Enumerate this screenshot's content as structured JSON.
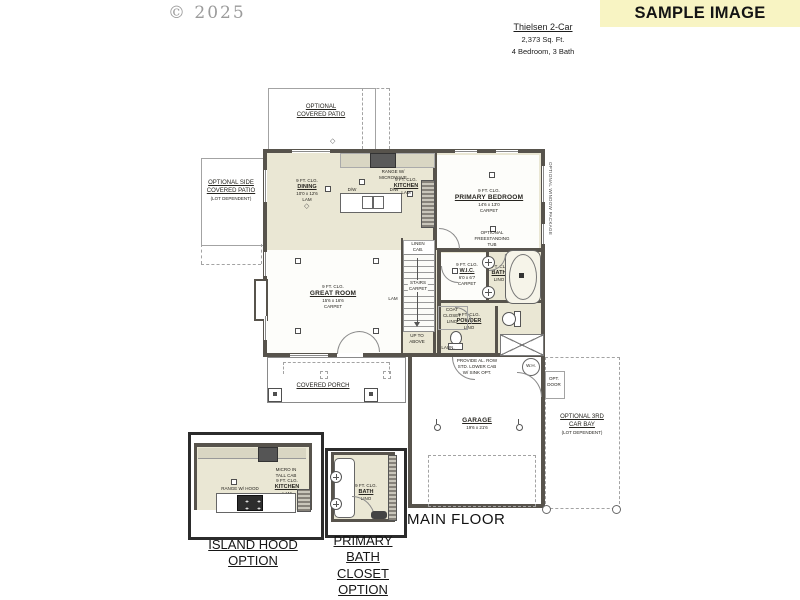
{
  "page": {
    "copyright": "© 2025",
    "main_floor": "MAIN FLOOR"
  },
  "banner": {
    "text": "SAMPLE IMAGE",
    "bg": "#f8f4c3"
  },
  "header": {
    "title": "Thielsen 2-Car",
    "sqft": "2,373 Sq. Ft.",
    "rooms": "4 Bedroom, 3 Bath"
  },
  "areas": {
    "patio_top": {
      "l1": "OPTIONAL",
      "l2": "COVERED PATIO"
    },
    "patio_side": {
      "l1": "OPTIONAL SIDE",
      "l2": "COVERED PATIO",
      "note": "(LOT DEPENDENT)"
    },
    "porch": {
      "label": "COVERED PORCH"
    },
    "car_bay": {
      "l1": "OPTIONAL 3RD",
      "l2": "CAR BAY",
      "note": "(LOT DEPENDENT)"
    }
  },
  "rooms": {
    "dining": {
      "clg": "9 FT. CLG.",
      "name": "DINING",
      "dims": "10'0 x 12'6",
      "floor": "LAM"
    },
    "kitchen": {
      "clg": "9 FT. CLG.",
      "name": "KITCHEN",
      "floor": "LAM"
    },
    "primary": {
      "clg": "9 FT. CLG.",
      "name": "PRIMARY BEDROOM",
      "dims": "14'6 x 13'0",
      "floor": "CARPET"
    },
    "great": {
      "clg": "9 FT. CLG.",
      "name": "GREAT ROOM",
      "dims": "15'6 x 16'6",
      "floor": "CARPET"
    },
    "wic": {
      "clg": "9 FT. CLG.",
      "name": "W.I.C.",
      "dims": "6'0 x 6'7",
      "floor": "CARPET"
    },
    "bath": {
      "clg": "9 FT. CLG.",
      "name": "BATH",
      "floor": "LINO"
    },
    "powder": {
      "clg": "9 FT. CLG.",
      "name": "POWDER",
      "floor": "LINO"
    },
    "garage": {
      "name": "GARAGE",
      "dims": "19'6 x 21'6"
    }
  },
  "small": {
    "range_micro_1": "RANGE W/",
    "range_micro_2": "MICROWAVE",
    "dw": "D/W",
    "coat_1": "COAT",
    "coat_2": "CLOSET",
    "coat_3": "LINO",
    "linen_1": "LINEN",
    "linen_2": "CAB.",
    "stairs_1": "STAIRS",
    "stairs_2": "CARPET",
    "stairs_up": "UP TO ABOVE",
    "hall_floor": "LAM",
    "laundry": "LAUN.",
    "tub_1": "OPTIONAL",
    "tub_2": "FREESTANDING",
    "tub_3": "TUB",
    "window_pkg": "OPTIONAL WINDOW PACKAGE",
    "garage_note_1": "PROVIDE AL. ROW",
    "garage_note_2": "STD. LOWER CAB",
    "garage_note_3": "W/ SINK OPT.",
    "wh": "W.H.",
    "opt_door_1": "OPT.",
    "opt_door_2": "DOOR"
  },
  "insets": {
    "island": {
      "caption_1": "ISLAND HOOD",
      "caption_2": "OPTION",
      "range": "RANGE W/ HOOD",
      "micro_1": "MICRO IN",
      "micro_2": "TALL CAB",
      "kitchen": {
        "clg": "9 FT. CLG.",
        "name": "KITCHEN",
        "floor": "LAM"
      }
    },
    "bathopt": {
      "caption_1": "PRIMARY BATH",
      "caption_2": "CLOSET OPTION",
      "bath": {
        "clg": "9 FT. CLG.",
        "name": "BATH",
        "floor": "LINO"
      }
    }
  }
}
